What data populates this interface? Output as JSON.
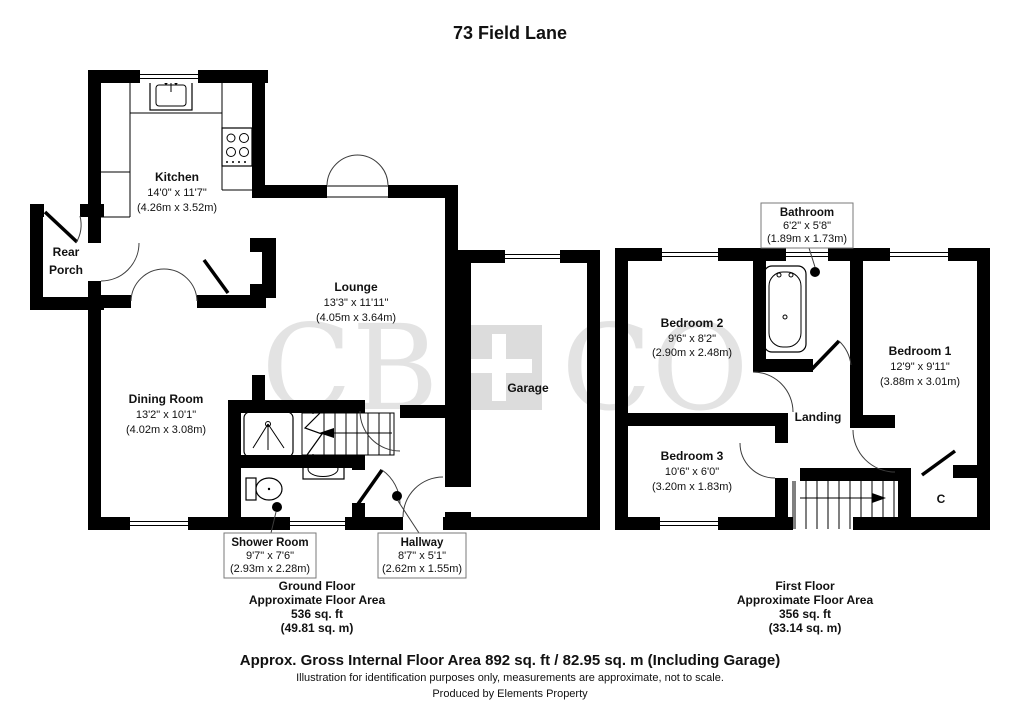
{
  "title": "73 Field Lane",
  "watermark": {
    "left": "CB",
    "right": "CO"
  },
  "ground_floor": {
    "kitchen": {
      "name": "Kitchen",
      "imperial": "14'0\" x 11'7\"",
      "metric": "(4.26m x 3.52m)"
    },
    "rear_porch": {
      "name_line1": "Rear",
      "name_line2": "Porch"
    },
    "lounge": {
      "name": "Lounge",
      "imperial": "13'3\" x 11'11\"",
      "metric": "(4.05m x 3.64m)"
    },
    "dining_room": {
      "name": "Dining Room",
      "imperial": "13'2\" x 10'1\"",
      "metric": "(4.02m x 3.08m)"
    },
    "shower_room": {
      "name": "Shower Room",
      "imperial": "9'7\" x 7'6\"",
      "metric": "(2.93m x 2.28m)"
    },
    "hallway": {
      "name": "Hallway",
      "imperial": "8'7\" x 5'1\"",
      "metric": "(2.62m x 1.55m)"
    },
    "garage": {
      "name": "Garage"
    },
    "summary": {
      "floor": "Ground Floor",
      "label": "Approximate Floor Area",
      "area_ft": "536 sq. ft",
      "area_m": "(49.81 sq. m)"
    }
  },
  "first_floor": {
    "bathroom": {
      "name": "Bathroom",
      "imperial": "6'2\" x 5'8\"",
      "metric": "(1.89m x 1.73m)"
    },
    "bedroom_1": {
      "name": "Bedroom 1",
      "imperial": "12'9\" x 9'11\"",
      "metric": "(3.88m x 3.01m)"
    },
    "bedroom_2": {
      "name": "Bedroom 2",
      "imperial": "9'6\" x 8'2\"",
      "metric": "(2.90m x 2.48m)"
    },
    "bedroom_3": {
      "name": "Bedroom 3",
      "imperial": "10'6\" x 6'0\"",
      "metric": "(3.20m x 1.83m)"
    },
    "landing": {
      "name": "Landing"
    },
    "cupboard": {
      "name": "C"
    },
    "summary": {
      "floor": "First Floor",
      "label": "Approximate Floor Area",
      "area_ft": "356 sq. ft",
      "area_m": "(33.14 sq. m)"
    }
  },
  "footer": {
    "gross_area": "Approx. Gross Internal Floor Area 892 sq. ft / 82.95 sq. m (Including Garage)",
    "disclaimer": "Illustration for identification purposes only, measurements are approximate, not to scale.",
    "produced_by": "Produced by Elements Property"
  },
  "colors": {
    "wall": "#000000",
    "watermark_text": "#e3e3e3",
    "watermark_square": "#dcdcdc",
    "background": "#ffffff"
  }
}
